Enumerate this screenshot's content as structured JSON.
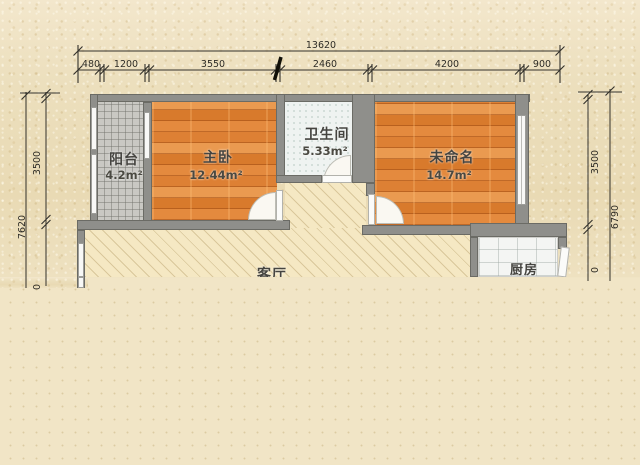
{
  "plan": {
    "type": "apartment-floor-plan",
    "rooms": {
      "balcony": {
        "name": "阳台",
        "area": "4.2m²"
      },
      "master": {
        "name": "主卧",
        "area": "12.44m²"
      },
      "bath": {
        "name": "卫生间",
        "area": "5.33m²"
      },
      "unnamed": {
        "name": "未命名",
        "area": "14.7m²"
      },
      "living": {
        "name": "客厅"
      },
      "kitchen": {
        "name": "厨房"
      }
    },
    "dimensions": {
      "top_total": "13620",
      "top_segments": [
        "480",
        "1200",
        "3550",
        "2460",
        "4200",
        "900"
      ],
      "left": {
        "inner": "3500",
        "outer": "7620",
        "partial": "0"
      },
      "right": {
        "inner": "3500",
        "outer": "6790",
        "partial": "0"
      }
    },
    "colors": {
      "paper_bg": "#ecdfbd",
      "lower_bg": "#f1e5c6",
      "wall": "#8f8f8b",
      "wood_floor": "#e0873c",
      "living_floor": "#f5e8c3",
      "balcony_tile": "#c9c8c3",
      "bath_tile": "#eff3f1",
      "label_text": "#454440"
    }
  }
}
